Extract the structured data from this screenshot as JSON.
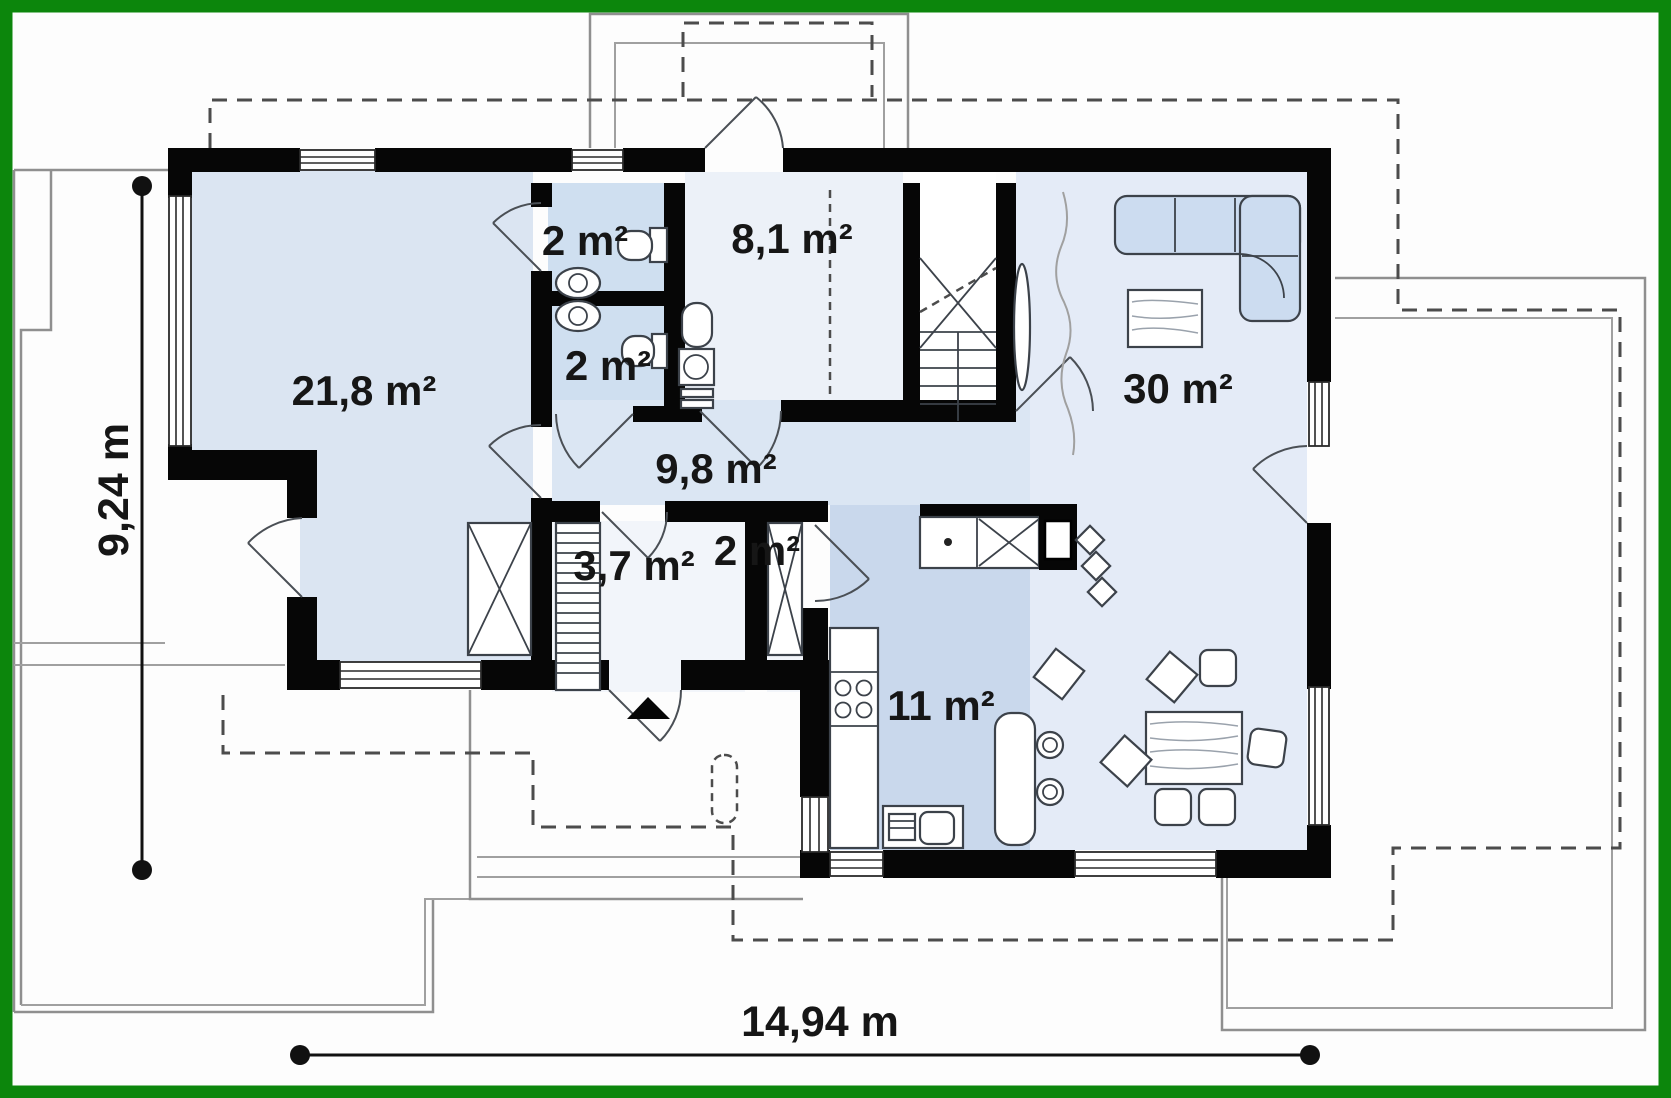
{
  "title": "Single storey house floor plan",
  "rooms": [
    {
      "id": "bathroom-top",
      "label": "2 m²"
    },
    {
      "id": "room-8-1",
      "label": "8,1 m²"
    },
    {
      "id": "bedroom",
      "label": "21,8 m²"
    },
    {
      "id": "bathroom-bottom",
      "label": "2 m²"
    },
    {
      "id": "hallway",
      "label": "9,8 m²"
    },
    {
      "id": "living-room",
      "label": "30 m²"
    },
    {
      "id": "dressing-room",
      "label": "3,7 m²"
    },
    {
      "id": "closet",
      "label": "2 m²"
    },
    {
      "id": "kitchen",
      "label": "11 m²"
    }
  ],
  "dimensions": {
    "depth": {
      "label": "9,24 m"
    },
    "width": {
      "label": "14,94 m"
    }
  },
  "colors": {
    "frame_green": "#0c860c",
    "wall_black": "#060606",
    "bedroom_fill": "#dbe5f2",
    "bath_fill": "#cfdff0",
    "hall_fill": "#dbe6f3",
    "room81_fill": "#ecf1f8",
    "living_fill": "#e4ebf7",
    "kitchen_fill": "#c9d8ec",
    "closet_fill": "#f2f5fa",
    "stair_fill": "#ffffff",
    "sofa_fill": "#ccdcf0"
  }
}
